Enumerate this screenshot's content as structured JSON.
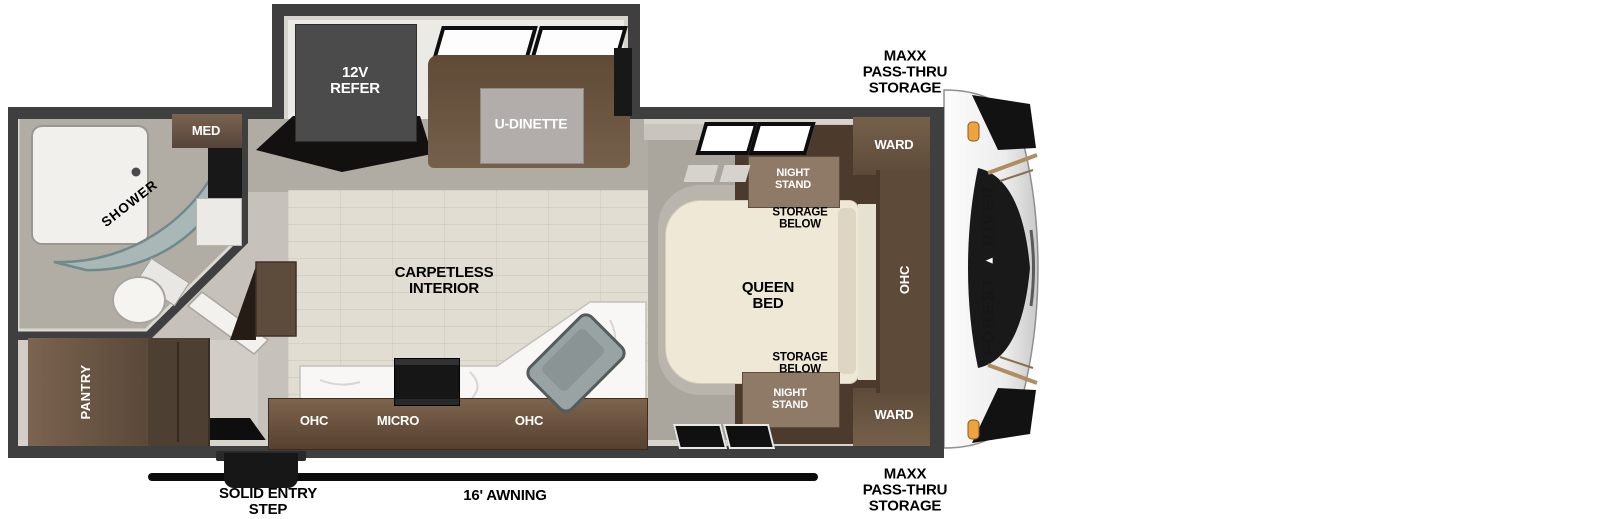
{
  "exterior": {
    "storage_top": "MAXX\nPASS-THRU\nSTORAGE",
    "storage_bottom": "MAXX\nPASS-THRU\nSTORAGE",
    "awning": "16' AWNING",
    "entry_step": "SOLID ENTRY\nSTEP"
  },
  "slide": {
    "refer": "12V\nREFER",
    "dinette": "U-DINETTE"
  },
  "living": {
    "carpetless": "CARPETLESS\nINTERIOR"
  },
  "kitchen": {
    "ohc_left": "OHC",
    "micro": "MICRO",
    "ohc_right": "OHC"
  },
  "bathroom": {
    "med": "MED",
    "shower": "SHOWER",
    "pantry": "PANTRY"
  },
  "bedroom": {
    "ward_top": "WARD",
    "ward_bottom": "WARD",
    "night_stand_top": "NIGHT\nSTAND",
    "night_stand_bottom": "NIGHT\nSTAND",
    "storage_below_top": "STORAGE\nBELOW",
    "storage_below_bottom": "STORAGE\nBELOW",
    "queen_bed": "QUEEN\nBED",
    "ohc": "OHC"
  },
  "brand": {
    "word1": "FOREST",
    "word2": "RIVER"
  },
  "colors": {
    "wall": "#3f3f3f",
    "wood_floor": "#e1ddd2",
    "floor_gray": "#b0aca4",
    "cabinet_brown": "#6a5441",
    "cabinet_dark": "#4c3b2d",
    "bed_cream": "#efe8d6",
    "counter_white": "#f8f7f5",
    "shower_glass": "#a5bec0",
    "marker_light": "#eda43e",
    "awning_black": "#0c0c0c"
  }
}
